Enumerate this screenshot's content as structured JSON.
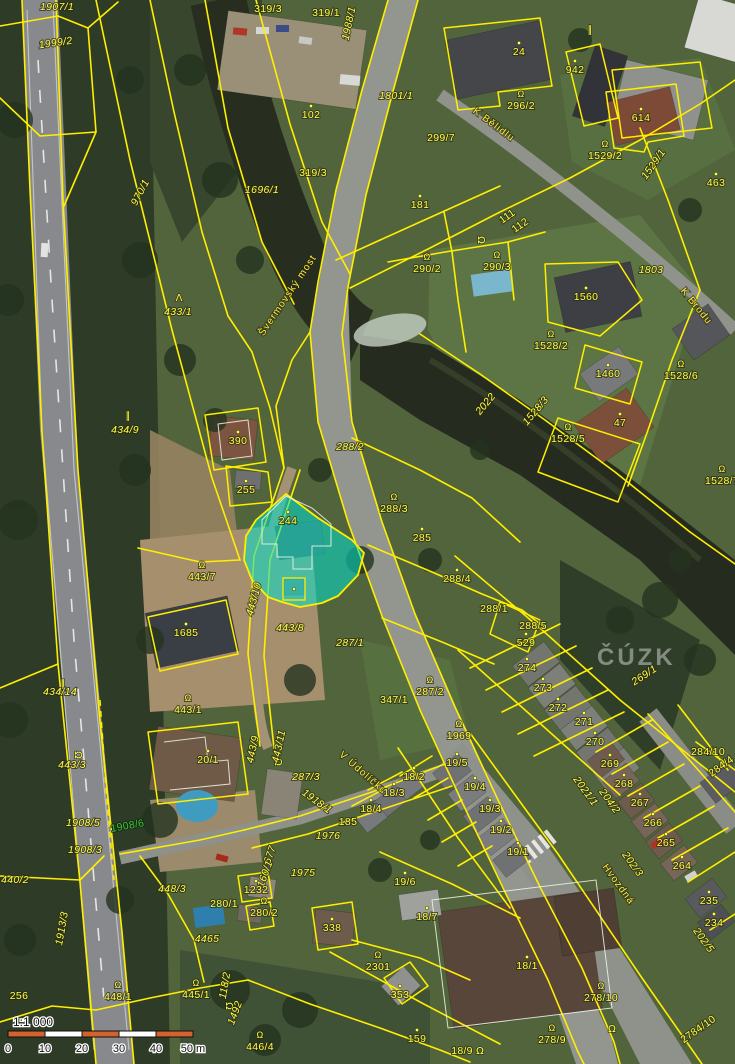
{
  "map": {
    "watermark": "ČÚZK",
    "highlight": {
      "parcel": "244",
      "fill": "rgba(0,224,204,0.55)",
      "border": "#ffee00"
    },
    "colors": {
      "boundary": "#ffee00",
      "parcel_label": "#ffff45",
      "green_label": "#3ec43e",
      "highlight_fill": "rgba(0,224,204,0.55)",
      "scalebar_orange": "#d2622e",
      "scalebar_white": "#ffffff"
    },
    "scale": {
      "ratio": "1:1 000",
      "bar": {
        "x": 8,
        "y": 1031,
        "seg_w": 37,
        "h": 6,
        "segments": [
          "#d2622e",
          "#ffffff",
          "#d2622e",
          "#ffffff",
          "#d2622e"
        ]
      },
      "ticks": [
        {
          "t": "0",
          "x": 8
        },
        {
          "t": "10",
          "x": 45
        },
        {
          "t": "20",
          "x": 82
        },
        {
          "t": "30",
          "x": 119
        },
        {
          "t": "40",
          "x": 156
        },
        {
          "t": "50 m",
          "x": 193
        }
      ]
    },
    "labels": [
      {
        "t": "1907/1",
        "x": 57,
        "y": 10,
        "s": "i"
      },
      {
        "t": "1999/2",
        "x": 56,
        "y": 46,
        "r": -8,
        "s": "i"
      },
      {
        "t": "319/3",
        "x": 268,
        "y": 12
      },
      {
        "t": "319/1",
        "x": 326,
        "y": 16
      },
      {
        "t": "1988/1",
        "x": 352,
        "y": 24,
        "r": -78,
        "s": "i"
      },
      {
        "t": "24",
        "x": 519,
        "y": 55,
        "d": 1
      },
      {
        "t": "942",
        "x": 575,
        "y": 73,
        "d": 1
      },
      {
        "t": "1801/1",
        "x": 396,
        "y": 99,
        "s": "i"
      },
      {
        "t": "296/2",
        "x": 521,
        "y": 109,
        "h": 1
      },
      {
        "t": "102",
        "x": 311,
        "y": 118,
        "d": 1
      },
      {
        "t": "614",
        "x": 641,
        "y": 121,
        "d": 1
      },
      {
        "t": "K Bělidlu",
        "x": 492,
        "y": 127,
        "r": 37,
        "s": "t"
      },
      {
        "t": "299/7",
        "x": 441,
        "y": 141
      },
      {
        "t": "1529/2",
        "x": 605,
        "y": 159,
        "h": 1
      },
      {
        "t": "1529/1",
        "x": 656,
        "y": 166,
        "r": -55,
        "s": "i"
      },
      {
        "t": "463",
        "x": 716,
        "y": 186,
        "d": 1
      },
      {
        "t": "970/1",
        "x": 143,
        "y": 194,
        "r": -62,
        "s": "i"
      },
      {
        "t": "1696/1",
        "x": 262,
        "y": 193,
        "s": "i"
      },
      {
        "t": "319/3",
        "x": 313,
        "y": 176
      },
      {
        "t": "181",
        "x": 420,
        "y": 208,
        "d": 1
      },
      {
        "t": "111",
        "x": 509,
        "y": 219,
        "r": -35
      },
      {
        "t": "112",
        "x": 522,
        "y": 228,
        "r": -35
      },
      {
        "t": "433/1",
        "x": 178,
        "y": 315,
        "s": "i"
      },
      {
        "t": "Švermovský most",
        "x": 290,
        "y": 297,
        "r": -56,
        "s": "t"
      },
      {
        "t": "290/2",
        "x": 427,
        "y": 272,
        "h": 1
      },
      {
        "t": "290/3",
        "x": 497,
        "y": 270,
        "h": 1
      },
      {
        "t": "1803",
        "x": 651,
        "y": 273,
        "s": "i"
      },
      {
        "t": "1560",
        "x": 586,
        "y": 300,
        "d": 1
      },
      {
        "t": "K Brodu",
        "x": 694,
        "y": 308,
        "r": 51,
        "s": "t"
      },
      {
        "t": "1528/2",
        "x": 551,
        "y": 349,
        "h": 1
      },
      {
        "t": "1460",
        "x": 608,
        "y": 377,
        "d": 1
      },
      {
        "t": "1528/6",
        "x": 681,
        "y": 379,
        "h": 1
      },
      {
        "t": "2022",
        "x": 488,
        "y": 406,
        "r": -50,
        "s": "i"
      },
      {
        "t": "1528/3",
        "x": 538,
        "y": 413,
        "r": -50,
        "s": "i"
      },
      {
        "t": "47",
        "x": 620,
        "y": 426,
        "d": 1
      },
      {
        "t": "1528/5",
        "x": 568,
        "y": 442,
        "h": 1
      },
      {
        "t": "434/9",
        "x": 125,
        "y": 433,
        "s": "i"
      },
      {
        "t": "390",
        "x": 238,
        "y": 444,
        "d": 1
      },
      {
        "t": "288/2",
        "x": 350,
        "y": 450,
        "s": "i"
      },
      {
        "t": "255",
        "x": 246,
        "y": 493,
        "d": 1
      },
      {
        "t": "1528/7",
        "x": 722,
        "y": 484,
        "h": 1
      },
      {
        "t": "288/3",
        "x": 394,
        "y": 512,
        "h": 1
      },
      {
        "t": "244",
        "x": 288,
        "y": 524,
        "d": 1
      },
      {
        "t": "285",
        "x": 422,
        "y": 541,
        "d": 1
      },
      {
        "t": "443/7",
        "x": 202,
        "y": 580,
        "h": 1
      },
      {
        "t": "288/4",
        "x": 457,
        "y": 582,
        "d": 1
      },
      {
        "t": "443/10",
        "x": 257,
        "y": 600,
        "r": -75,
        "s": "i"
      },
      {
        "t": "288/1",
        "x": 494,
        "y": 612
      },
      {
        "t": "288/5",
        "x": 533,
        "y": 629
      },
      {
        "t": "443/8",
        "x": 290,
        "y": 631,
        "s": "i"
      },
      {
        "t": "1685",
        "x": 186,
        "y": 636,
        "d": 1
      },
      {
        "t": "287/1",
        "x": 350,
        "y": 646,
        "s": "i"
      },
      {
        "t": "529",
        "x": 526,
        "y": 646,
        "d": 1
      },
      {
        "t": "274",
        "x": 527,
        "y": 671,
        "d": 1
      },
      {
        "t": "269/1",
        "x": 646,
        "y": 678,
        "r": -33,
        "s": "i"
      },
      {
        "t": "434/14",
        "x": 60,
        "y": 695,
        "s": "i"
      },
      {
        "t": "273",
        "x": 543,
        "y": 691,
        "d": 1
      },
      {
        "t": "287/2",
        "x": 430,
        "y": 695,
        "h": 1
      },
      {
        "t": "347/1",
        "x": 394,
        "y": 703
      },
      {
        "t": "443/1",
        "x": 188,
        "y": 713,
        "h": 1
      },
      {
        "t": "272",
        "x": 558,
        "y": 711,
        "d": 1
      },
      {
        "t": "271",
        "x": 584,
        "y": 725,
        "d": 1
      },
      {
        "t": "1969",
        "x": 459,
        "y": 739,
        "h": 1
      },
      {
        "t": "270",
        "x": 595,
        "y": 745,
        "d": 1
      },
      {
        "t": "443/9",
        "x": 256,
        "y": 750,
        "r": -78,
        "s": "i"
      },
      {
        "t": "443/11",
        "x": 282,
        "y": 747,
        "r": -78,
        "s": "i"
      },
      {
        "t": "284/10",
        "x": 708,
        "y": 755
      },
      {
        "t": "284/4",
        "x": 723,
        "y": 769,
        "r": -35
      },
      {
        "t": "20/1",
        "x": 208,
        "y": 763,
        "d": 1
      },
      {
        "t": "269",
        "x": 610,
        "y": 767,
        "d": 1
      },
      {
        "t": "19/5",
        "x": 457,
        "y": 766,
        "d": 1
      },
      {
        "t": "443/3",
        "x": 72,
        "y": 768,
        "s": "i"
      },
      {
        "t": "287/3",
        "x": 306,
        "y": 780,
        "s": "i"
      },
      {
        "t": "V Údolíčku",
        "x": 361,
        "y": 775,
        "r": 41,
        "s": "t"
      },
      {
        "t": "18/2",
        "x": 414,
        "y": 780,
        "d": 1
      },
      {
        "t": "268",
        "x": 624,
        "y": 787,
        "d": 1
      },
      {
        "t": "19/4",
        "x": 475,
        "y": 790,
        "d": 1
      },
      {
        "t": "2021/1",
        "x": 583,
        "y": 793,
        "r": 54,
        "s": "i"
      },
      {
        "t": "18/3",
        "x": 394,
        "y": 796,
        "d": 1
      },
      {
        "t": "1918/1",
        "x": 315,
        "y": 804,
        "r": 36,
        "s": "i"
      },
      {
        "t": "204/2",
        "x": 607,
        "y": 803,
        "r": 54,
        "s": "i"
      },
      {
        "t": "267",
        "x": 640,
        "y": 806,
        "d": 1
      },
      {
        "t": "18/4",
        "x": 371,
        "y": 812,
        "d": 1
      },
      {
        "t": "19/3",
        "x": 490,
        "y": 812,
        "d": 1
      },
      {
        "t": "1908/5",
        "x": 83,
        "y": 826,
        "s": "i"
      },
      {
        "t": "185",
        "x": 348,
        "y": 825
      },
      {
        "t": "1908/6",
        "x": 128,
        "y": 829,
        "r": -10,
        "s": "g"
      },
      {
        "t": "19/2",
        "x": 501,
        "y": 833,
        "d": 1
      },
      {
        "t": "266",
        "x": 653,
        "y": 826,
        "d": 1
      },
      {
        "t": "1976",
        "x": 328,
        "y": 839,
        "s": "i"
      },
      {
        "t": "265",
        "x": 666,
        "y": 846,
        "d": 1
      },
      {
        "t": "1908/3",
        "x": 85,
        "y": 853,
        "s": "i"
      },
      {
        "t": "19/1",
        "x": 518,
        "y": 855,
        "d": 1
      },
      {
        "t": "677",
        "x": 273,
        "y": 856,
        "r": -70,
        "s": "i"
      },
      {
        "t": "202/3",
        "x": 630,
        "y": 866,
        "r": 54,
        "s": "i"
      },
      {
        "t": "264",
        "x": 682,
        "y": 869,
        "d": 1
      },
      {
        "t": "160/1",
        "x": 268,
        "y": 875,
        "r": -70,
        "s": "i"
      },
      {
        "t": "1975",
        "x": 303,
        "y": 876,
        "s": "i"
      },
      {
        "t": "440/2",
        "x": 15,
        "y": 883,
        "s": "i"
      },
      {
        "t": "Hvozdná",
        "x": 616,
        "y": 886,
        "r": 54,
        "s": "t"
      },
      {
        "t": "19/6",
        "x": 405,
        "y": 885,
        "d": 1
      },
      {
        "t": "448/3",
        "x": 172,
        "y": 892,
        "s": "i"
      },
      {
        "t": "1232",
        "x": 256,
        "y": 893,
        "d": 1
      },
      {
        "t": "280/1",
        "x": 224,
        "y": 907
      },
      {
        "t": "235",
        "x": 709,
        "y": 904,
        "d": 1
      },
      {
        "t": "280/2",
        "x": 264,
        "y": 916,
        "h": 1
      },
      {
        "t": "18/7",
        "x": 427,
        "y": 920,
        "d": 1
      },
      {
        "t": "234",
        "x": 714,
        "y": 926,
        "d": 1
      },
      {
        "t": "1913/3",
        "x": 65,
        "y": 929,
        "r": -80,
        "s": "i"
      },
      {
        "t": "338",
        "x": 332,
        "y": 931,
        "d": 1
      },
      {
        "t": "4465",
        "x": 207,
        "y": 942,
        "s": "i"
      },
      {
        "t": "202/5",
        "x": 701,
        "y": 942,
        "r": 54,
        "s": "i"
      },
      {
        "t": "2301",
        "x": 378,
        "y": 970,
        "h": 1
      },
      {
        "t": "18/1",
        "x": 527,
        "y": 969,
        "d": 1
      },
      {
        "t": "445/1",
        "x": 196,
        "y": 998,
        "h": 1
      },
      {
        "t": "353",
        "x": 400,
        "y": 998,
        "d": 1
      },
      {
        "t": "448/1",
        "x": 118,
        "y": 1000,
        "h": 1
      },
      {
        "t": "256",
        "x": 19,
        "y": 999
      },
      {
        "t": "118/2",
        "x": 228,
        "y": 986,
        "r": -80,
        "s": "i"
      },
      {
        "t": "278/10",
        "x": 601,
        "y": 1001,
        "h": 1
      },
      {
        "t": "1492",
        "x": 238,
        "y": 1014,
        "r": -70,
        "s": "i"
      },
      {
        "t": "159",
        "x": 417,
        "y": 1042,
        "d": 1
      },
      {
        "t": "2784/10",
        "x": 700,
        "y": 1032,
        "r": -35
      },
      {
        "t": "446/4",
        "x": 260,
        "y": 1050,
        "h": 1
      },
      {
        "t": "18/9",
        "x": 462,
        "y": 1054
      },
      {
        "t": "278/9",
        "x": 552,
        "y": 1043,
        "h": 1
      }
    ],
    "symbols": [
      {
        "k": "tree",
        "x": 179,
        "y": 301
      },
      {
        "k": "dash",
        "x": 128,
        "y": 419
      },
      {
        "k": "dash",
        "x": 63,
        "y": 687
      },
      {
        "k": "dash",
        "x": 590,
        "y": 33
      },
      {
        "k": "hook",
        "x": 75,
        "y": 755,
        "r": 90
      },
      {
        "k": "hook",
        "x": 275,
        "y": 762,
        "r": 90
      },
      {
        "k": "hook",
        "x": 226,
        "y": 1006,
        "r": 90
      },
      {
        "k": "hook",
        "x": 478,
        "y": 240,
        "r": 90
      },
      {
        "k": "hook",
        "x": 480,
        "y": 1054
      },
      {
        "k": "hook",
        "x": 612,
        "y": 1032
      },
      {
        "k": "dot",
        "x": 294,
        "y": 589
      }
    ]
  }
}
